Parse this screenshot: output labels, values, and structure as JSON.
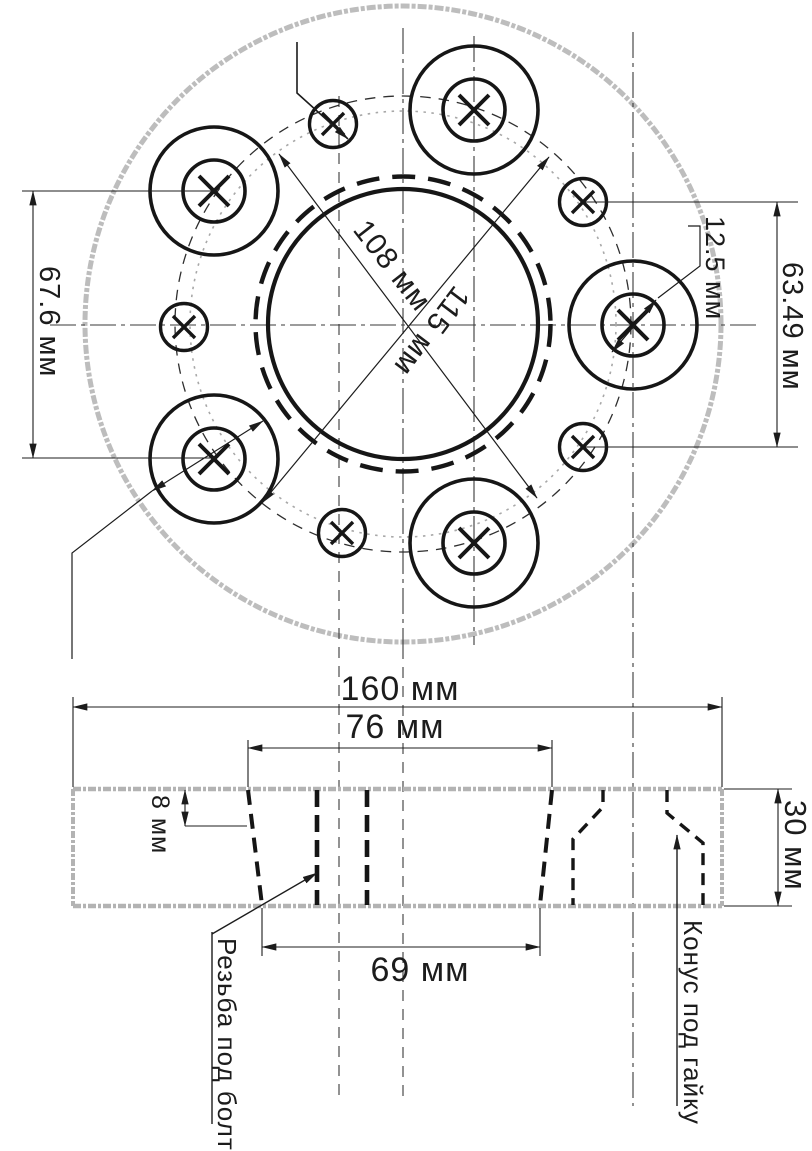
{
  "drawing": {
    "ink_color": "#1c1c1c",
    "faint_color": "#b6b6b6",
    "top_view": {
      "pcd_inner": "108 мм",
      "pcd_outer": "115 мм",
      "chord_left": "67.6 мм",
      "chord_right": "63.49 мм",
      "bolt_hole_diameter": "12.5 мм",
      "seat_diameter": "30 мм"
    },
    "section_view": {
      "overall_width": "160 мм",
      "recess_top_width": "76 мм",
      "recess_bottom_width": "69 мм",
      "recess_depth": "8 мм",
      "plate_thickness": "30 мм",
      "thread_note": "Резьба под болт",
      "cone_note": "Конус под гайку"
    }
  }
}
